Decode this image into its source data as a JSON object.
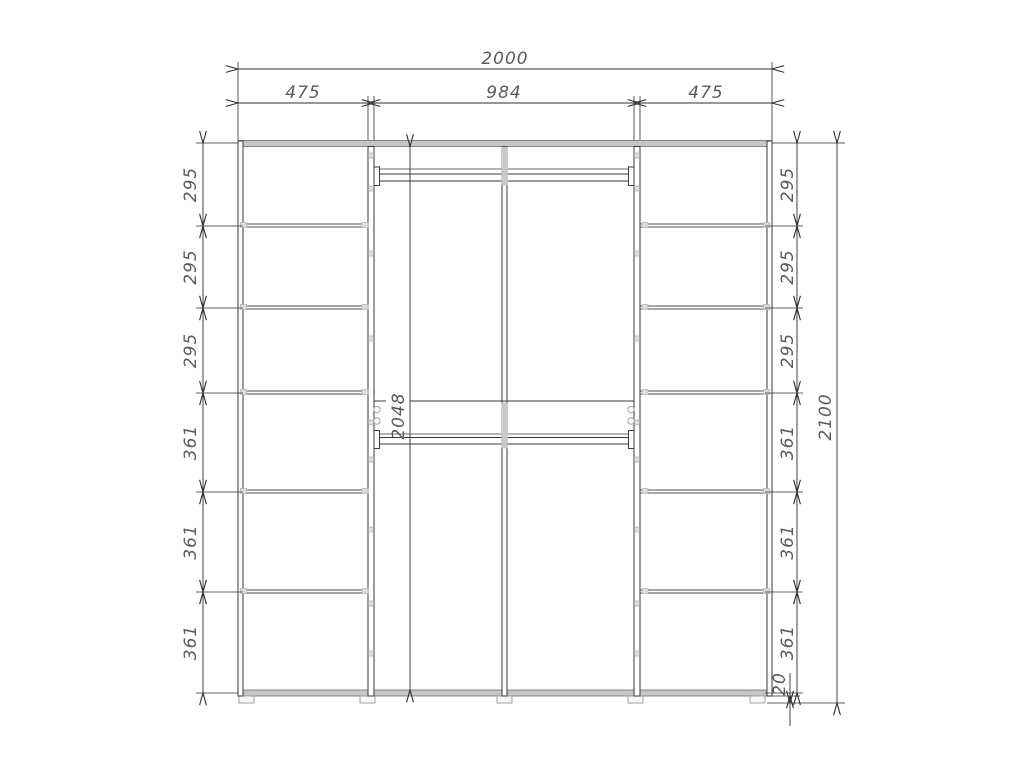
{
  "drawing": {
    "type": "furniture-elevation",
    "subject": "wardrobe-front-view-with-dimensions",
    "units_shown": "mm"
  },
  "dims": {
    "top": {
      "overall": "2000",
      "segments": [
        "475",
        "984",
        "475"
      ]
    },
    "left": [
      "295",
      "295",
      "295",
      "361",
      "361",
      "361"
    ],
    "right": [
      "295",
      "295",
      "295",
      "361",
      "361",
      "361"
    ],
    "height_overall": "2100",
    "interior_height": "2048",
    "feet_height": "20"
  },
  "colors": {
    "background": "#ffffff",
    "structure_line": "#3a3a3a",
    "dimension_line": "#2f2f2f",
    "dimension_text": "#5a5a5a",
    "panel_fill": "#c6c6c6",
    "fitting_fill": "#dedede"
  }
}
